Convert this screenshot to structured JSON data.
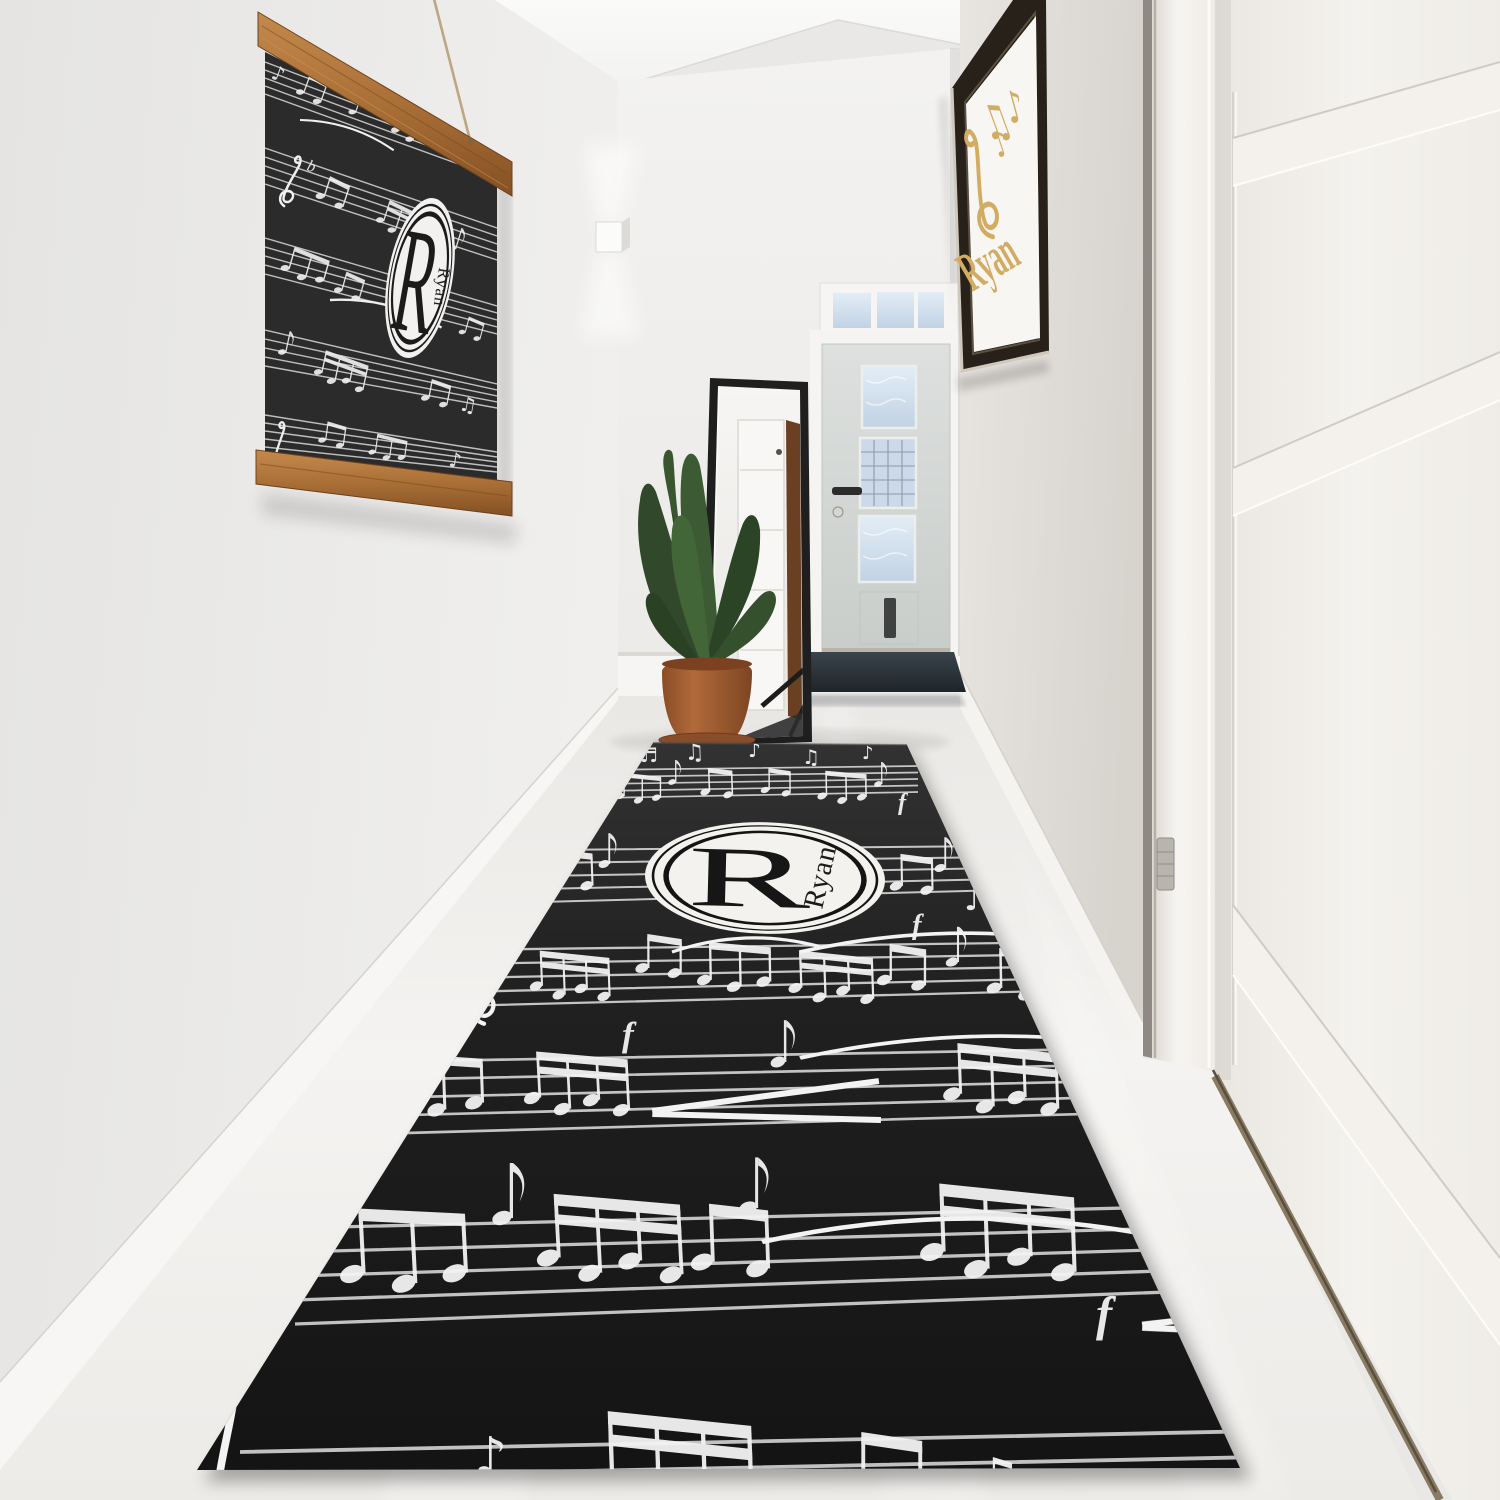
{
  "monograms": {
    "rug": {
      "initial": "R",
      "name": "Ryan"
    },
    "wall_hanging": {
      "initial": "R",
      "name": "Ryan"
    },
    "framed_print": {
      "name": "Ryan"
    }
  },
  "music_symbols": {
    "eighth_note": "♪",
    "beamed_notes": "♫",
    "beamed_sixteenths": "♬",
    "forte": "f",
    "flat": "b"
  },
  "palette": {
    "rug_black": "#1e1e1e",
    "canvas_black": "#2b2b2b",
    "monogram_white": "#f3f2ef",
    "print_gold": "#d2ac62",
    "hanger_wood": "#b07a3e",
    "pot_terracotta": "#a05c32",
    "leaf_green": "#3c5a33",
    "wall_white": "#eae9e7",
    "floor_white": "#f2f1ef",
    "doormat_charcoal": "#262e34",
    "mirror_frame_black": "#1f1f1f"
  }
}
